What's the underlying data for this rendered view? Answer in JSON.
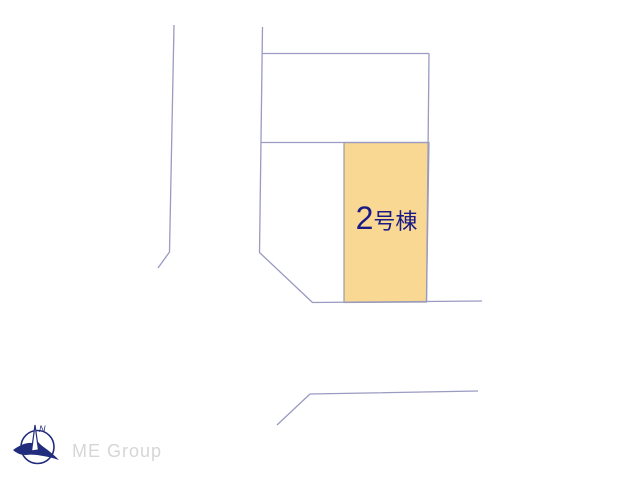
{
  "plan": {
    "parcel": {
      "label_number": "2",
      "label_suffix": "号棟",
      "fill_color": "#f8d893",
      "label_color": "#1a1a86"
    },
    "line_color": "#9a9ac2"
  },
  "logo": {
    "north_label": "N",
    "company": "ME Group",
    "icon_color": "#222c7c",
    "text_color": "#d6d6d6"
  }
}
